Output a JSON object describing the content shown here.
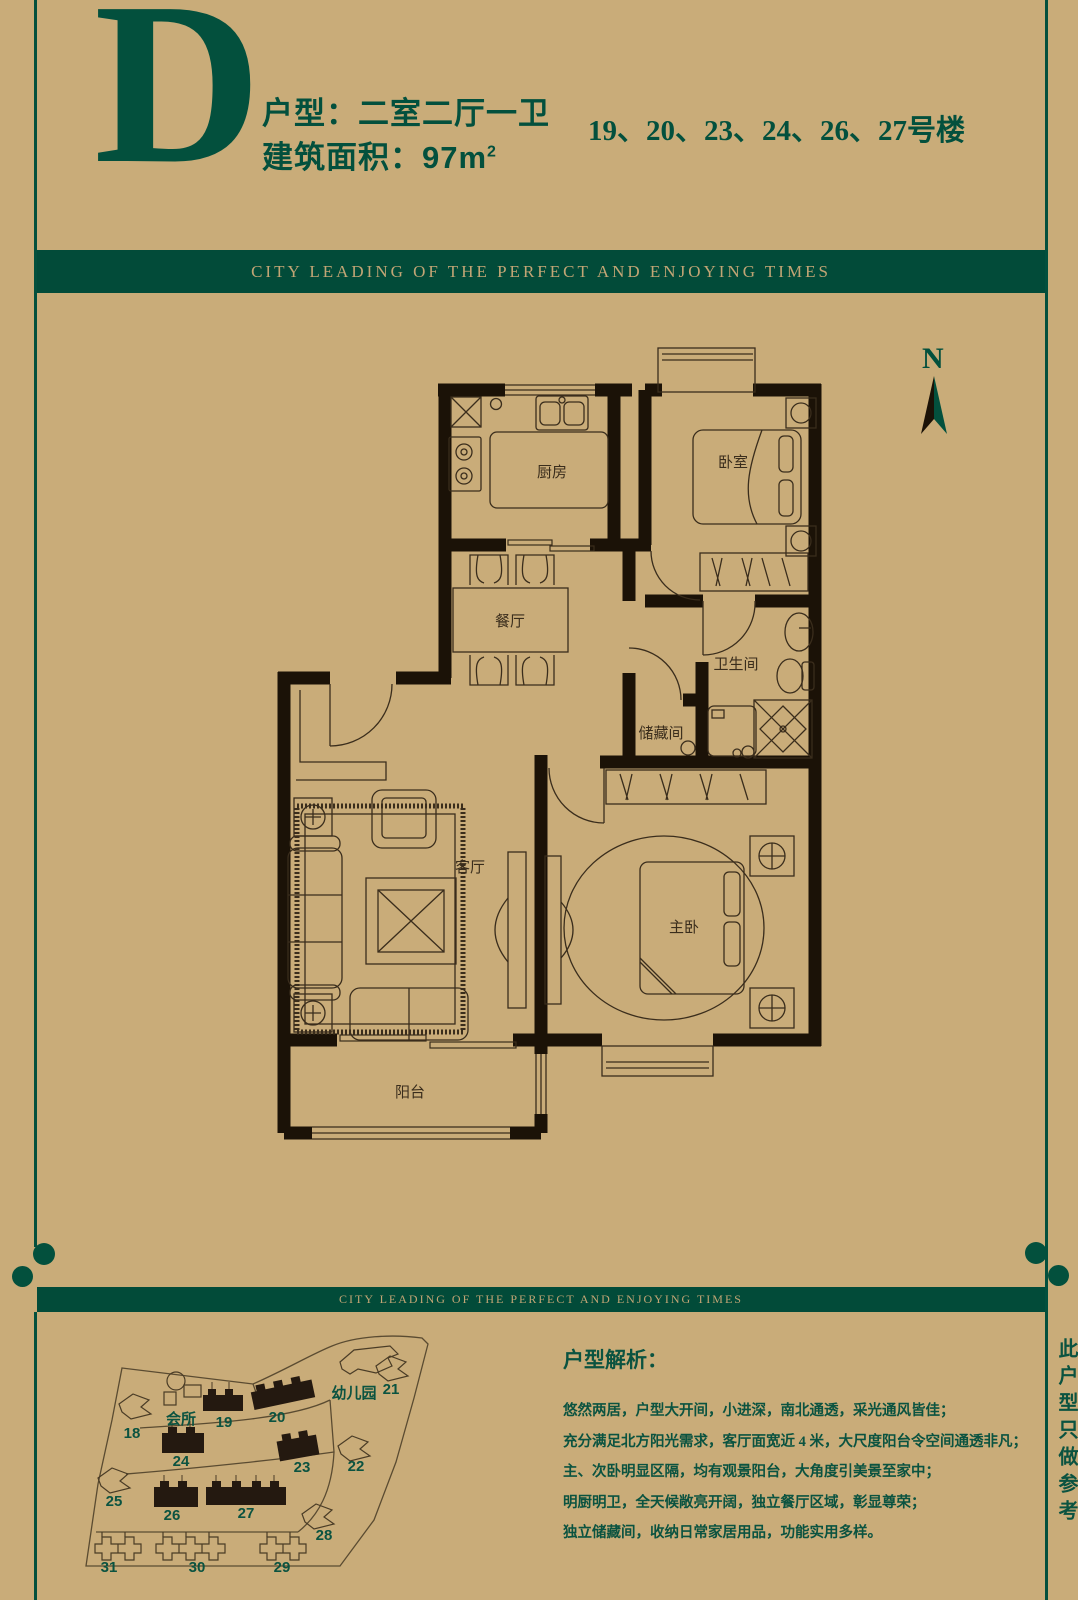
{
  "colors": {
    "green": "#03503d",
    "tan": "#c9ac79",
    "ink": "#1b1207"
  },
  "header": {
    "plan_letter": "D",
    "unit_type": "户型：二室二厅一卫",
    "area_prefix": "建筑面积：97m",
    "area_sup": "2",
    "buildings_line": "19、20、23、24、26、27号楼"
  },
  "banner": {
    "text": "CITY LEADING OF THE PERFECT AND ENJOYING TIMES"
  },
  "floorplan": {
    "north": "N",
    "rooms": {
      "kitchen": "厨房",
      "bedroom": "卧室",
      "dining": "餐厅",
      "bath": "卫生间",
      "storage": "储藏间",
      "living": "客厅",
      "master": "主卧",
      "balcony": "阳台"
    }
  },
  "sitemap": {
    "clubhouse": "会所",
    "kindergarten": "幼儿园",
    "buildings": [
      {
        "label": "18"
      },
      {
        "label": "19"
      },
      {
        "label": "20"
      },
      {
        "label": "21"
      },
      {
        "label": "22"
      },
      {
        "label": "23"
      },
      {
        "label": "24"
      },
      {
        "label": "25"
      },
      {
        "label": "26"
      },
      {
        "label": "27"
      },
      {
        "label": "28"
      },
      {
        "label": "29"
      },
      {
        "label": "30"
      },
      {
        "label": "31"
      }
    ]
  },
  "analysis": {
    "heading": "户型解析：",
    "lines": [
      "悠然两居，户型大开间，小进深，南北通透，采光通风皆佳；",
      "充分满足北方阳光需求，客厅面宽近 4 米，大尺度阳台令空间通透非凡；",
      "主、次卧明显区隔，均有观景阳台，大角度引美景至家中；",
      "明厨明卫，全天候敞亮开阔，独立餐厅区域，彰显尊荣；",
      "独立储藏间，收纳日常家居用品，功能实用多样。"
    ]
  },
  "side_note": "此户型只做参考"
}
